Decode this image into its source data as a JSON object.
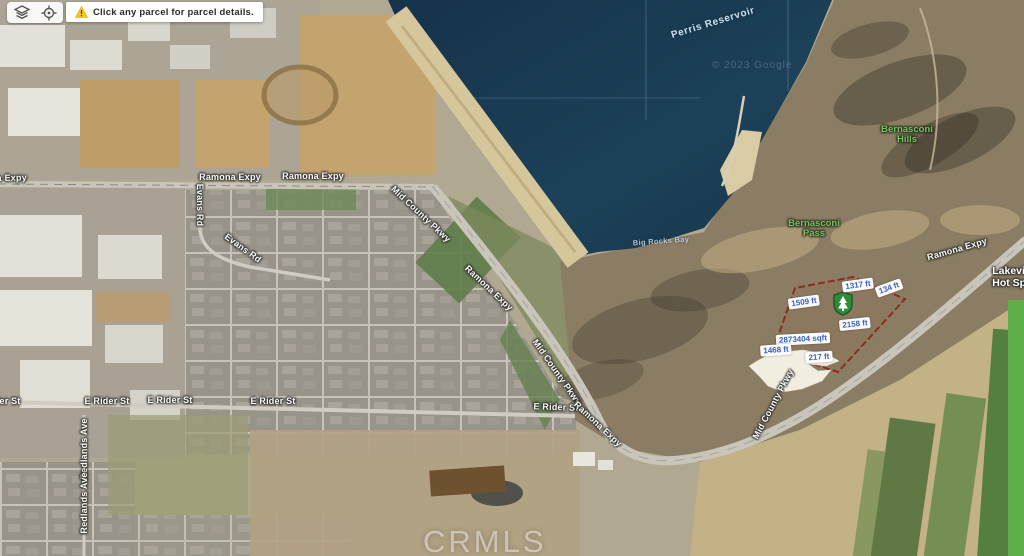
{
  "toolbar": {
    "tooltip_text": "Click any parcel for parcel details.",
    "icons": [
      {
        "name": "layers-icon"
      },
      {
        "name": "crosshair-icon"
      }
    ],
    "warning_color": "#f0b429"
  },
  "map": {
    "imagery_credit": "© 2023 Google",
    "road_labels": [
      {
        "text": "Ramona Expy",
        "x": -4,
        "y": 178,
        "rot": -1
      },
      {
        "text": "Ramona Expy",
        "x": 230,
        "y": 177,
        "rot": 0
      },
      {
        "text": "Ramona Expy",
        "x": 313,
        "y": 176,
        "rot": 0
      },
      {
        "text": "Evans Rd",
        "x": 200,
        "y": 205,
        "rot": 90
      },
      {
        "text": "Evans Rd",
        "x": 243,
        "y": 248,
        "rot": 36
      },
      {
        "text": "Mid County Pkwy",
        "x": 421,
        "y": 214,
        "rot": 43
      },
      {
        "text": "Ramona Expy",
        "x": 489,
        "y": 288,
        "rot": 43
      },
      {
        "text": "Mid County Pkwy",
        "x": 557,
        "y": 372,
        "rot": 55
      },
      {
        "text": "E Rider St",
        "x": -2,
        "y": 401,
        "rot": 0
      },
      {
        "text": "E Rider St",
        "x": 107,
        "y": 401,
        "rot": 0
      },
      {
        "text": "E Rider St",
        "x": 170,
        "y": 400,
        "rot": 0
      },
      {
        "text": "E Rider St",
        "x": 273,
        "y": 401,
        "rot": 0
      },
      {
        "text": "E Rider St",
        "x": 556,
        "y": 407,
        "rot": 2
      },
      {
        "text": "Ramona Expy",
        "x": 598,
        "y": 424,
        "rot": 43
      },
      {
        "text": "Mid County Pkwy",
        "x": 773,
        "y": 404,
        "rot": -62
      },
      {
        "text": "Ramona Expy",
        "x": 957,
        "y": 249,
        "rot": -16
      },
      {
        "text": "Redlands Ave",
        "x": 84,
        "y": 449,
        "rot": -90
      },
      {
        "text": "Redlands Ave",
        "x": 84,
        "y": 503,
        "rot": -90
      }
    ],
    "water_labels": [
      {
        "text": "Perris Reservoir",
        "x": 713,
        "y": 23,
        "rot": -17,
        "kind": "reservoir"
      },
      {
        "text": "Big Rocks Bay",
        "x": 661,
        "y": 241,
        "rot": -4,
        "kind": "bay"
      }
    ],
    "terrain_labels": [
      {
        "line1": "Bernasconi",
        "line2": "Hills",
        "x": 907,
        "y": 135
      },
      {
        "line1": "Bernasconi",
        "line2": "Pass",
        "x": 814,
        "y": 229
      }
    ],
    "place_label": {
      "line1": "Lakeview",
      "line2": "Hot Springs",
      "x": 1022,
      "y": 277
    }
  },
  "parcel": {
    "measurements": [
      {
        "text": "1317 ft",
        "x": 858,
        "y": 285,
        "rot": -8
      },
      {
        "text": "134 ft",
        "x": 889,
        "y": 288,
        "rot": -20
      },
      {
        "text": "1509 ft",
        "x": 804,
        "y": 302,
        "rot": -8
      },
      {
        "text": "2158 ft",
        "x": 855,
        "y": 324,
        "rot": -6
      },
      {
        "text": "2873404 sqft",
        "x": 803,
        "y": 339,
        "rot": -3
      },
      {
        "text": "1468 ft",
        "x": 776,
        "y": 350,
        "rot": -4
      },
      {
        "text": "217 ft",
        "x": 819,
        "y": 357,
        "rot": -4
      }
    ],
    "marker": "protected-area-shield-tree",
    "boundary_color": "#8e2418",
    "highlight_color": "#f6f2e7",
    "measure_text_color": "#3a62c4",
    "marker_color": "#2e8b3a"
  },
  "watermark": {
    "text": "CRMLS"
  }
}
